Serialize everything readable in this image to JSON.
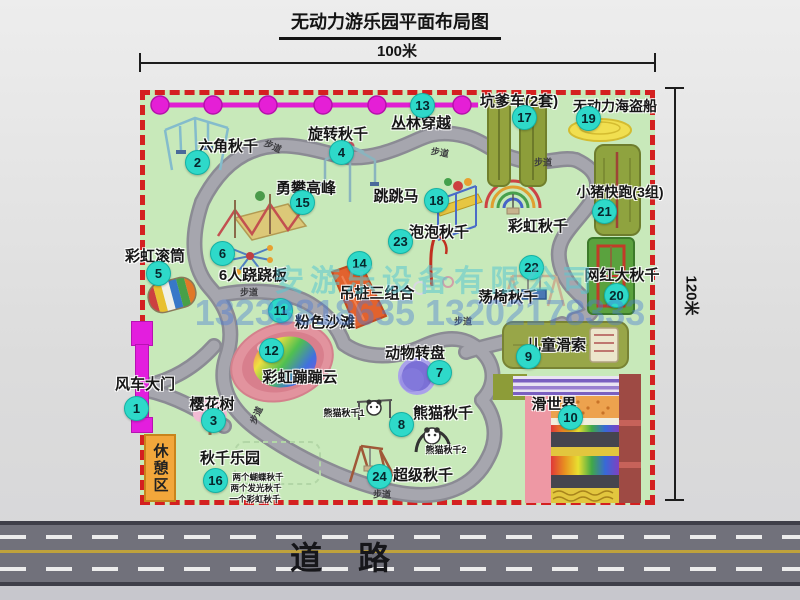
{
  "title": "无动力游乐园平面布局图",
  "dimensions": {
    "width": "100米",
    "height": "120米"
  },
  "road": {
    "label": "道路"
  },
  "park": {
    "walkway_label": "步道"
  },
  "watermark": {
    "company": "安游乐设备有限公司",
    "phone": "13233818635 13202178333"
  },
  "unnumbered": {
    "rainbow_swing": "彩虹秋千",
    "rest_area": "休憩区"
  },
  "attractions": [
    {
      "num": "1",
      "name": "风车大门"
    },
    {
      "num": "2",
      "name": "六角秋千"
    },
    {
      "num": "3",
      "name": "樱花树"
    },
    {
      "num": "4",
      "name": "旋转秋千"
    },
    {
      "num": "5",
      "name": "彩虹滚筒"
    },
    {
      "num": "6",
      "name": "6人跷跷板"
    },
    {
      "num": "7",
      "name": "动物转盘"
    },
    {
      "num": "8",
      "name": "熊猫秋千",
      "sub1": "熊猫秋千1",
      "sub2": "熊猫秋千2"
    },
    {
      "num": "9",
      "name": "儿童滑索"
    },
    {
      "num": "10",
      "name": "滑世界"
    },
    {
      "num": "11",
      "name": "粉色沙滩"
    },
    {
      "num": "12",
      "name": "彩虹蹦蹦云"
    },
    {
      "num": "13",
      "name": "丛林穿越"
    },
    {
      "num": "14",
      "name": "吊桩三组合"
    },
    {
      "num": "15",
      "name": "勇攀高峰"
    },
    {
      "num": "16",
      "name": "秋千乐园",
      "details": [
        "两个蝴蝶秋千",
        "两个发光秋千",
        "一个彩虹秋千"
      ]
    },
    {
      "num": "17",
      "name": "坑爹车(2套)"
    },
    {
      "num": "18",
      "name": "跳跳马"
    },
    {
      "num": "19",
      "name": "无动力海盗船"
    },
    {
      "num": "20",
      "name": "网红大秋千"
    },
    {
      "num": "21",
      "name": "小猪快跑(3组)"
    },
    {
      "num": "22",
      "name": "荡椅秋千"
    },
    {
      "num": "23",
      "name": "泡泡秋千"
    },
    {
      "num": "24",
      "name": "超级秋千"
    }
  ],
  "colors": {
    "park_green": "#c8e9ba",
    "border_red": "#d42020",
    "badge_cyan": "#2ed9c9",
    "magenta": "#e31ede",
    "road_asphalt": "#71717b",
    "rest_orange": "#f2a73b"
  }
}
